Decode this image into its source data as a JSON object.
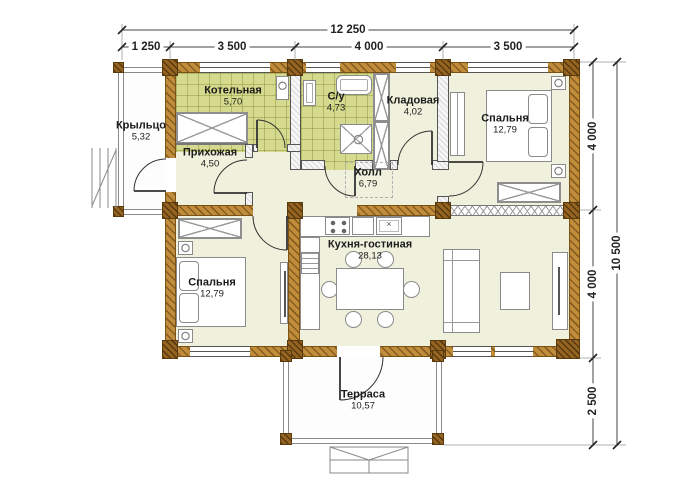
{
  "plan": {
    "rooms": [
      {
        "id": "porch",
        "name": "Крыльцо",
        "area": "5,32"
      },
      {
        "id": "boiler-room",
        "name": "Котельная",
        "area": "5,70"
      },
      {
        "id": "entry-hall",
        "name": "Прихожая",
        "area": "4,50"
      },
      {
        "id": "bathroom",
        "name": "С/у",
        "area": "4,73"
      },
      {
        "id": "storage",
        "name": "Кладовая",
        "area": "4,02"
      },
      {
        "id": "bedroom-top",
        "name": "Спальня",
        "area": "12,79"
      },
      {
        "id": "hall",
        "name": "Холл",
        "area": "6,79"
      },
      {
        "id": "bedroom-bottom",
        "name": "Спальня",
        "area": "12,79"
      },
      {
        "id": "kitchen-living",
        "name": "Кухня-гостиная",
        "area": "28,13"
      },
      {
        "id": "terrace",
        "name": "Терраса",
        "area": "10,57"
      }
    ],
    "dimensions": {
      "top_total": "12 250",
      "top_segments": [
        "1 250",
        "3 500",
        "4 000",
        "3 500"
      ],
      "right_segments": [
        "4 000",
        "4 000",
        "2 500"
      ],
      "right_total": "10 500"
    },
    "icons": {
      "sink_marker": "×"
    },
    "colors": {
      "floor": "#f0f1dc",
      "tiled_floor": "#d6da8e",
      "timber_wall": "#c28d3a",
      "timber_post": "#946420",
      "dimension_text": "#222222"
    }
  }
}
